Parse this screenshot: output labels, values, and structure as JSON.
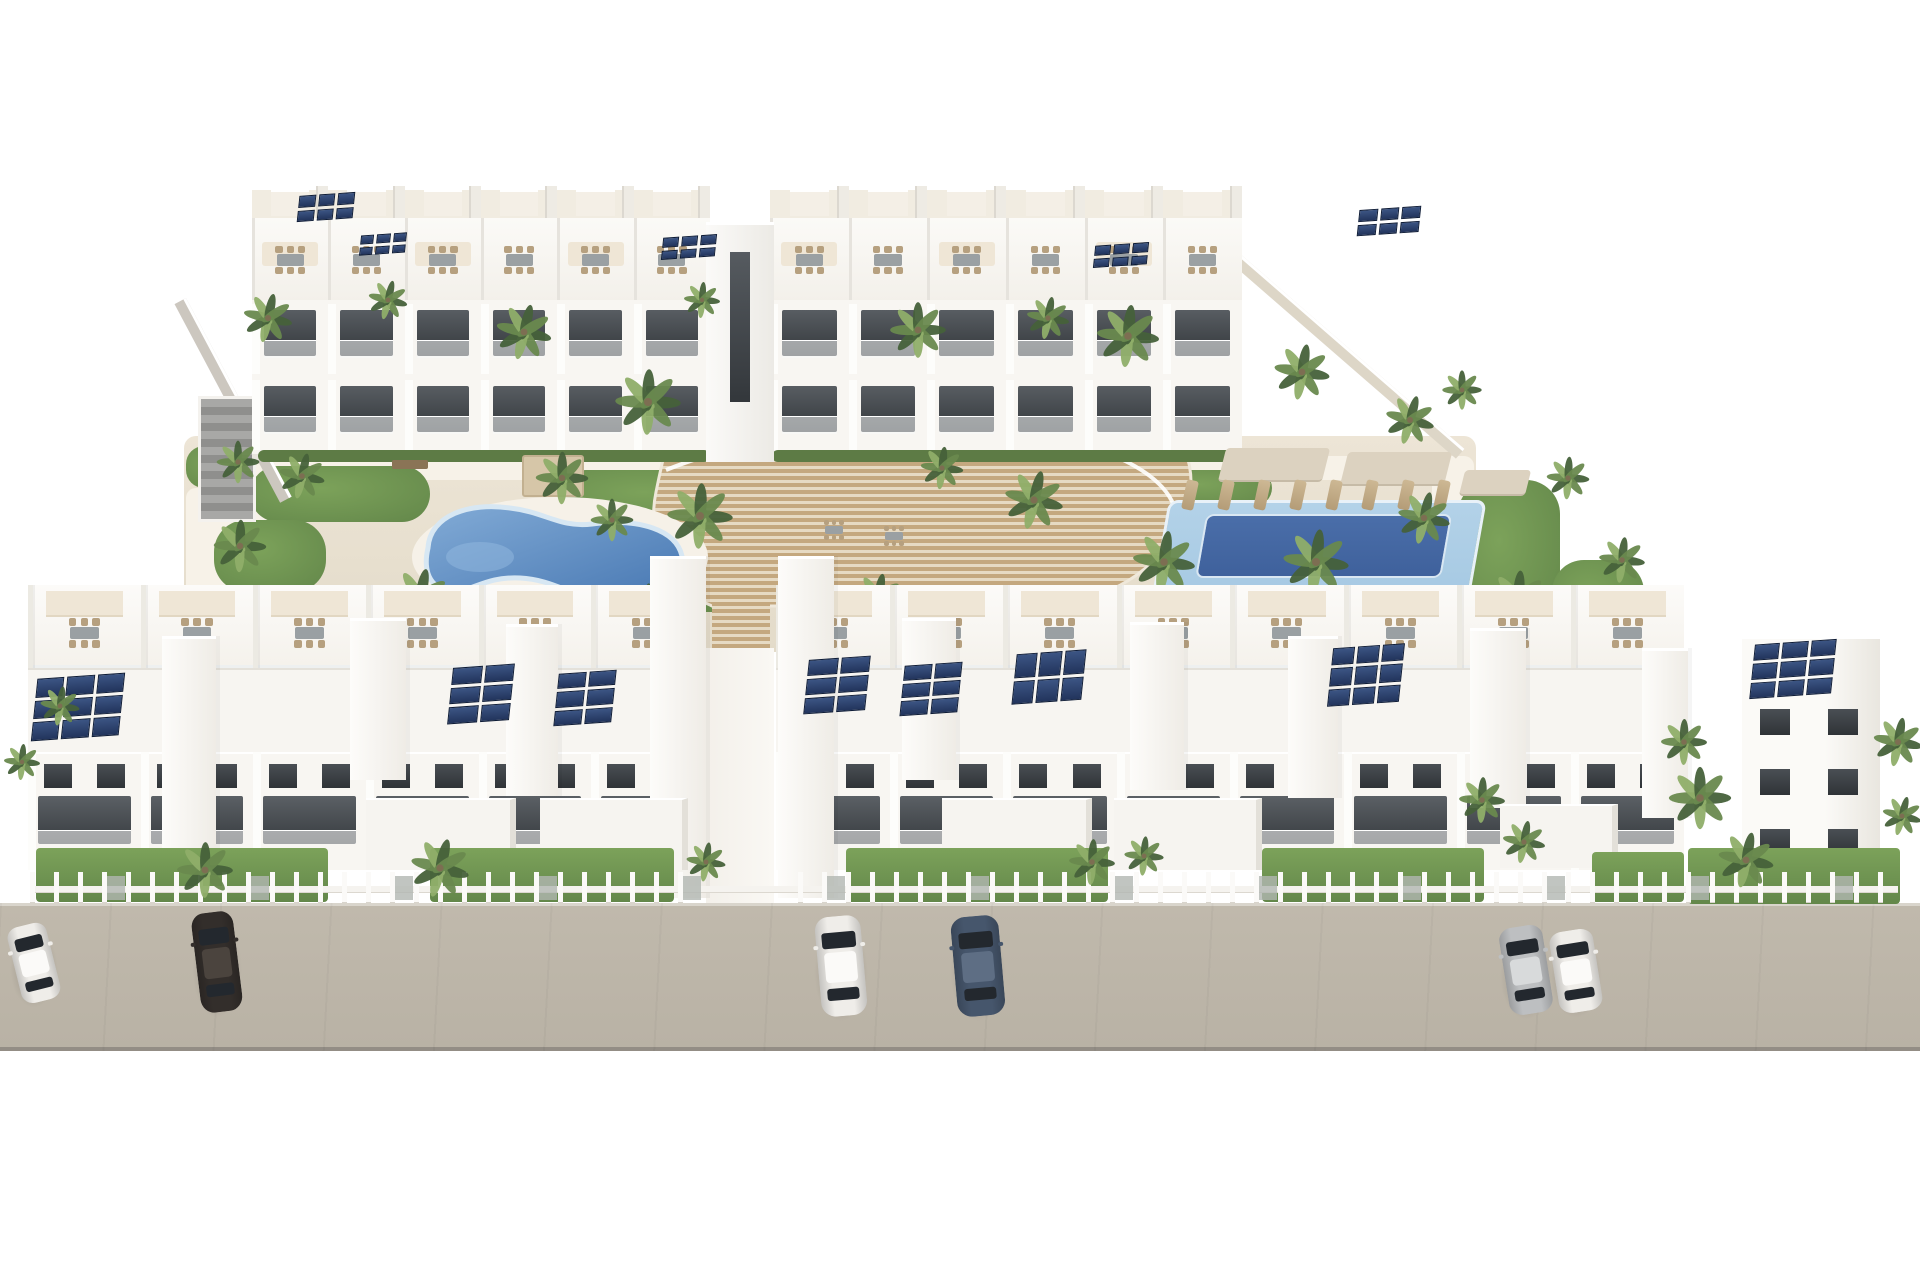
{
  "meta": {
    "description": "3D architectural rendering of a white residential apartment complex with rooftop solar panels, two courtyard swimming pools, a central curved wooden stair deck, palm trees, garden fences and cars parked on a front street",
    "width": 1920,
    "height": 1280
  },
  "palette": {
    "bg": "#ffffff",
    "ground": "#ede5d6",
    "ground_dark": "#e3dbc9",
    "path": "#f7f2e8",
    "lawn": "#7ca25a",
    "lawn_dark": "#63874a",
    "hedge": "#5d7b45",
    "wall_white": "#f8f6f2",
    "wall_bright": "#fdfdfb",
    "wall_shade": "#e8e5de",
    "roof_cream": "#f1ece1",
    "win_dark": "#35393d",
    "win_mid": "#5b6065",
    "wood_a": "#c4a87f",
    "wood_light": "#e6dac3",
    "pool_left_deep": "#4777b2",
    "pool_left_light": "#82abd6",
    "pool_rim": "#d7e7f3",
    "pool_right_outer": "#a6c9e3",
    "pool_right_inner": "#3f619c",
    "street": "#b9b2a5",
    "street_edge": "#938d85",
    "curb": "#d9d5cc",
    "solar_cell": "#3c5584",
    "solar_deep": "#22345c",
    "solar_line": "#0d1b36",
    "furn_tan": "#b6a07f",
    "furn_gray": "#9aa0a3",
    "canopy": "#efe6d6",
    "sail": "#dcd2c0",
    "palm_dark": "#46613a",
    "palm_mid": "#69894e",
    "palm_light": "#8fae69",
    "trunk": "#7d6e52",
    "glass": "#23282e",
    "wall_beige": "#ddd6c7",
    "wall_gray": "#ccc7bf",
    "struct_gray": "#9a9a98"
  },
  "car_colors": {
    "white": [
      "#efede9",
      "#fbfaf8"
    ],
    "black": [
      "#332e2b",
      "#4b443e"
    ],
    "blue": [
      "#46566c",
      "#5e6e84"
    ],
    "silver": [
      "#bdbfc1",
      "#d8dadb"
    ]
  },
  "scene": {
    "courtyard": {
      "x": 184,
      "y": 436,
      "w": 1292,
      "h": 216
    },
    "paths": [
      {
        "x": 228,
        "y": 456,
        "w": 1246,
        "h": 24
      },
      {
        "x": 186,
        "y": 488,
        "w": 110,
        "h": 158
      },
      {
        "x": 1432,
        "y": 470,
        "w": 44,
        "h": 178
      }
    ],
    "gardens": [
      {
        "x": 250,
        "y": 466,
        "w": 180,
        "h": 56,
        "r": 28
      },
      {
        "x": 214,
        "y": 520,
        "w": 112,
        "h": 72,
        "r": 32
      },
      {
        "x": 560,
        "y": 470,
        "w": 210,
        "h": 56,
        "r": 26
      },
      {
        "x": 640,
        "y": 520,
        "w": 150,
        "h": 92,
        "r": 40
      },
      {
        "x": 300,
        "y": 590,
        "w": 150,
        "h": 48,
        "r": 24
      },
      {
        "x": 470,
        "y": 606,
        "w": 122,
        "h": 36,
        "r": 18
      },
      {
        "x": 186,
        "y": 446,
        "w": 70,
        "h": 42,
        "r": 18
      },
      {
        "x": 898,
        "y": 462,
        "w": 240,
        "h": 60,
        "r": 28
      },
      {
        "x": 1152,
        "y": 470,
        "w": 120,
        "h": 36,
        "r": 18
      },
      {
        "x": 1458,
        "y": 480,
        "w": 102,
        "h": 152,
        "r": 34
      },
      {
        "x": 1052,
        "y": 600,
        "w": 152,
        "h": 42,
        "r": 20
      },
      {
        "x": 1552,
        "y": 560,
        "w": 92,
        "h": 82,
        "r": 32
      },
      {
        "x": 836,
        "y": 560,
        "w": 80,
        "h": 60,
        "r": 26
      }
    ],
    "left_wall": {
      "x": 186,
      "y": 298,
      "len": 225,
      "th": 13,
      "ang": 62
    },
    "right_wall": {
      "x": 1238,
      "y": 252,
      "len": 300,
      "th": 13,
      "ang": 41
    },
    "stairs_structure": {
      "x": 198,
      "y": 396,
      "w": 58,
      "h": 126
    },
    "back_blocks": [
      {
        "x": 252,
        "w": 458,
        "m": 6
      },
      {
        "x": 770,
        "w": 472,
        "m": 6
      }
    ],
    "center_tower": {
      "x": 706,
      "y": 222,
      "w": 68,
      "h": 240
    },
    "hedges": [
      {
        "x": 258,
        "y": 450,
        "w": 452,
        "h": 12
      },
      {
        "x": 772,
        "y": 450,
        "w": 470,
        "h": 12
      }
    ],
    "back_solar": [
      {
        "x": 298,
        "y": 194,
        "w": 56,
        "h": 26,
        "c": 3,
        "r": 2
      },
      {
        "x": 360,
        "y": 234,
        "w": 46,
        "h": 20,
        "c": 3,
        "r": 2
      },
      {
        "x": 662,
        "y": 236,
        "w": 54,
        "h": 22,
        "c": 3,
        "r": 2
      },
      {
        "x": 1094,
        "y": 244,
        "w": 54,
        "h": 22,
        "c": 3,
        "r": 2
      },
      {
        "x": 1358,
        "y": 208,
        "w": 62,
        "h": 26,
        "c": 3,
        "r": 2
      }
    ],
    "deck": {
      "body": "M 700 332 L 864 332 C 1000 344 1140 376 1178 436 C 1200 472 1196 524 1152 562 C 1130 584 1096 600 1052 606 L 712 606 C 668 588 646 540 656 492 C 664 452 678 396 700 332 Z",
      "rail1": "M 666 470 C 770 428 920 418 1020 432 C 1110 444 1162 474 1174 506",
      "rail2": "M 700 336 C 830 350 990 372 1090 412",
      "tongue": {
        "x": 712,
        "y": 596,
        "w": 58,
        "h": 62
      }
    },
    "pool_left": {
      "x": 410,
      "y": 495,
      "w": 300,
      "h": 125
    },
    "pool_right": {
      "x": 1160,
      "y": 500,
      "w": 318,
      "h": 100,
      "inner": {
        "x": 40,
        "y": 14,
        "w": 246,
        "h": 64
      }
    },
    "pergola": {
      "x": 522,
      "y": 455,
      "w": 62,
      "h": 42
    },
    "bench": {
      "x": 392,
      "y": 460,
      "w": 36,
      "h": 9
    },
    "sails": [
      {
        "x": 1222,
        "y": 448,
        "w": 104,
        "h": 34
      },
      {
        "x": 1344,
        "y": 452,
        "w": 104,
        "h": 34
      },
      {
        "x": 1462,
        "y": 470,
        "w": 66,
        "h": 26
      }
    ],
    "loungers_right": {
      "x": 1184,
      "y": 480,
      "count": 8,
      "step": 36
    },
    "loungers_left": {
      "x": 628,
      "y": 588,
      "count": 3,
      "step": 30
    },
    "deck_tables": [
      {
        "x": 834,
        "y": 530
      },
      {
        "x": 894,
        "y": 536
      }
    ],
    "walkway": {
      "x": 706,
      "y": 648,
      "w": 68,
      "h": 258
    },
    "front_blocks": [
      {
        "x": 28,
        "w": 676,
        "m": 6
      },
      {
        "x": 776,
        "w": 908,
        "m": 8
      }
    ],
    "front_bands": {
      "terrace_y": 585,
      "terrace_h": 83,
      "roof_y": 668,
      "roof_h": 84,
      "facade_y": 752,
      "facade_h": 118
    },
    "towers": [
      {
        "x": 162,
        "y": 636,
        "w": 54,
        "h": 212
      },
      {
        "x": 350,
        "y": 618,
        "w": 56,
        "h": 162
      },
      {
        "x": 506,
        "y": 624,
        "w": 52,
        "h": 172
      },
      {
        "x": 650,
        "y": 556,
        "w": 56,
        "h": 342
      },
      {
        "x": 778,
        "y": 556,
        "w": 56,
        "h": 342
      },
      {
        "x": 902,
        "y": 618,
        "w": 54,
        "h": 162
      },
      {
        "x": 1130,
        "y": 622,
        "w": 54,
        "h": 168
      },
      {
        "x": 1288,
        "y": 636,
        "w": 50,
        "h": 162
      },
      {
        "x": 1470,
        "y": 628,
        "w": 56,
        "h": 180
      },
      {
        "x": 1642,
        "y": 648,
        "w": 46,
        "h": 170
      }
    ],
    "front_solar": [
      {
        "x": 34,
        "y": 676,
        "w": 88,
        "h": 62,
        "c": 3,
        "r": 3
      },
      {
        "x": 450,
        "y": 666,
        "w": 62,
        "h": 56,
        "c": 2,
        "r": 3
      },
      {
        "x": 556,
        "y": 672,
        "w": 58,
        "h": 52,
        "c": 2,
        "r": 3
      },
      {
        "x": 806,
        "y": 658,
        "w": 62,
        "h": 54,
        "c": 2,
        "r": 3
      },
      {
        "x": 902,
        "y": 664,
        "w": 58,
        "h": 50,
        "c": 2,
        "r": 3
      },
      {
        "x": 1014,
        "y": 652,
        "w": 70,
        "h": 50,
        "c": 3,
        "r": 2
      },
      {
        "x": 1330,
        "y": 646,
        "w": 72,
        "h": 58,
        "c": 3,
        "r": 3
      },
      {
        "x": 1752,
        "y": 642,
        "w": 82,
        "h": 54,
        "c": 3,
        "r": 3
      }
    ],
    "ground_volumes": [
      {
        "x": 366,
        "y": 798,
        "w": 150,
        "h": 72
      },
      {
        "x": 540,
        "y": 798,
        "w": 148,
        "h": 72
      },
      {
        "x": 942,
        "y": 798,
        "w": 150,
        "h": 72
      },
      {
        "x": 1114,
        "y": 798,
        "w": 148,
        "h": 72
      },
      {
        "x": 1500,
        "y": 804,
        "w": 118,
        "h": 64
      }
    ],
    "corner_building": {
      "x": 1742,
      "y": 636,
      "w": 138,
      "h": 252
    },
    "street": {
      "x": 0,
      "y": 903,
      "w": 1920,
      "h": 148
    },
    "lawns": [
      {
        "x": 36,
        "y": 848,
        "w": 292,
        "h": 54
      },
      {
        "x": 430,
        "y": 848,
        "w": 244,
        "h": 54
      },
      {
        "x": 846,
        "y": 848,
        "w": 262,
        "h": 54
      },
      {
        "x": 1262,
        "y": 848,
        "w": 222,
        "h": 54
      },
      {
        "x": 1592,
        "y": 852,
        "w": 92,
        "h": 50
      },
      {
        "x": 1688,
        "y": 848,
        "w": 212,
        "h": 56
      }
    ],
    "fence": {
      "y": 872,
      "x1": 30,
      "x2": 1898,
      "gap_start": 700,
      "gap_end": 780
    },
    "palms": [
      {
        "x": 268,
        "y": 318,
        "s": 30
      },
      {
        "x": 388,
        "y": 300,
        "s": 24
      },
      {
        "x": 524,
        "y": 332,
        "s": 34
      },
      {
        "x": 648,
        "y": 402,
        "s": 40
      },
      {
        "x": 702,
        "y": 300,
        "s": 22
      },
      {
        "x": 918,
        "y": 330,
        "s": 34
      },
      {
        "x": 1048,
        "y": 318,
        "s": 26
      },
      {
        "x": 1128,
        "y": 336,
        "s": 38
      },
      {
        "x": 1302,
        "y": 372,
        "s": 34
      },
      {
        "x": 1410,
        "y": 420,
        "s": 30
      },
      {
        "x": 1462,
        "y": 390,
        "s": 24
      },
      {
        "x": 238,
        "y": 462,
        "s": 26
      },
      {
        "x": 302,
        "y": 476,
        "s": 28
      },
      {
        "x": 240,
        "y": 546,
        "s": 32
      },
      {
        "x": 420,
        "y": 598,
        "s": 36
      },
      {
        "x": 562,
        "y": 478,
        "s": 32
      },
      {
        "x": 612,
        "y": 520,
        "s": 26
      },
      {
        "x": 700,
        "y": 516,
        "s": 40
      },
      {
        "x": 648,
        "y": 608,
        "s": 30
      },
      {
        "x": 878,
        "y": 598,
        "s": 30
      },
      {
        "x": 942,
        "y": 468,
        "s": 26
      },
      {
        "x": 1034,
        "y": 500,
        "s": 36
      },
      {
        "x": 1164,
        "y": 562,
        "s": 38
      },
      {
        "x": 1316,
        "y": 562,
        "s": 40
      },
      {
        "x": 1424,
        "y": 518,
        "s": 32
      },
      {
        "x": 1518,
        "y": 600,
        "s": 36
      },
      {
        "x": 1568,
        "y": 478,
        "s": 26
      },
      {
        "x": 1622,
        "y": 560,
        "s": 28
      },
      {
        "x": 205,
        "y": 870,
        "s": 34
      },
      {
        "x": 440,
        "y": 868,
        "s": 36
      },
      {
        "x": 60,
        "y": 706,
        "s": 24
      },
      {
        "x": 22,
        "y": 762,
        "s": 22
      },
      {
        "x": 706,
        "y": 862,
        "s": 24
      },
      {
        "x": 1092,
        "y": 862,
        "s": 28
      },
      {
        "x": 1144,
        "y": 856,
        "s": 24
      },
      {
        "x": 1482,
        "y": 800,
        "s": 28
      },
      {
        "x": 1524,
        "y": 842,
        "s": 26
      },
      {
        "x": 1700,
        "y": 798,
        "s": 38
      },
      {
        "x": 1746,
        "y": 860,
        "s": 34
      },
      {
        "x": 1684,
        "y": 742,
        "s": 28
      },
      {
        "x": 1898,
        "y": 742,
        "s": 30
      },
      {
        "x": 1902,
        "y": 816,
        "s": 24
      }
    ],
    "cars": [
      {
        "x": 14,
        "y": 924,
        "w": 40,
        "l": 78,
        "rot": -14,
        "c": "white"
      },
      {
        "x": 196,
        "y": 912,
        "w": 42,
        "l": 100,
        "rot": -7,
        "c": "black"
      },
      {
        "x": 818,
        "y": 916,
        "w": 46,
        "l": 100,
        "rot": -5,
        "c": "white"
      },
      {
        "x": 954,
        "y": 916,
        "w": 48,
        "l": 100,
        "rot": -5,
        "c": "blue"
      },
      {
        "x": 1504,
        "y": 926,
        "w": 44,
        "l": 88,
        "rot": -9,
        "c": "silver"
      },
      {
        "x": 1554,
        "y": 930,
        "w": 44,
        "l": 82,
        "rot": -9,
        "c": "white"
      }
    ]
  }
}
